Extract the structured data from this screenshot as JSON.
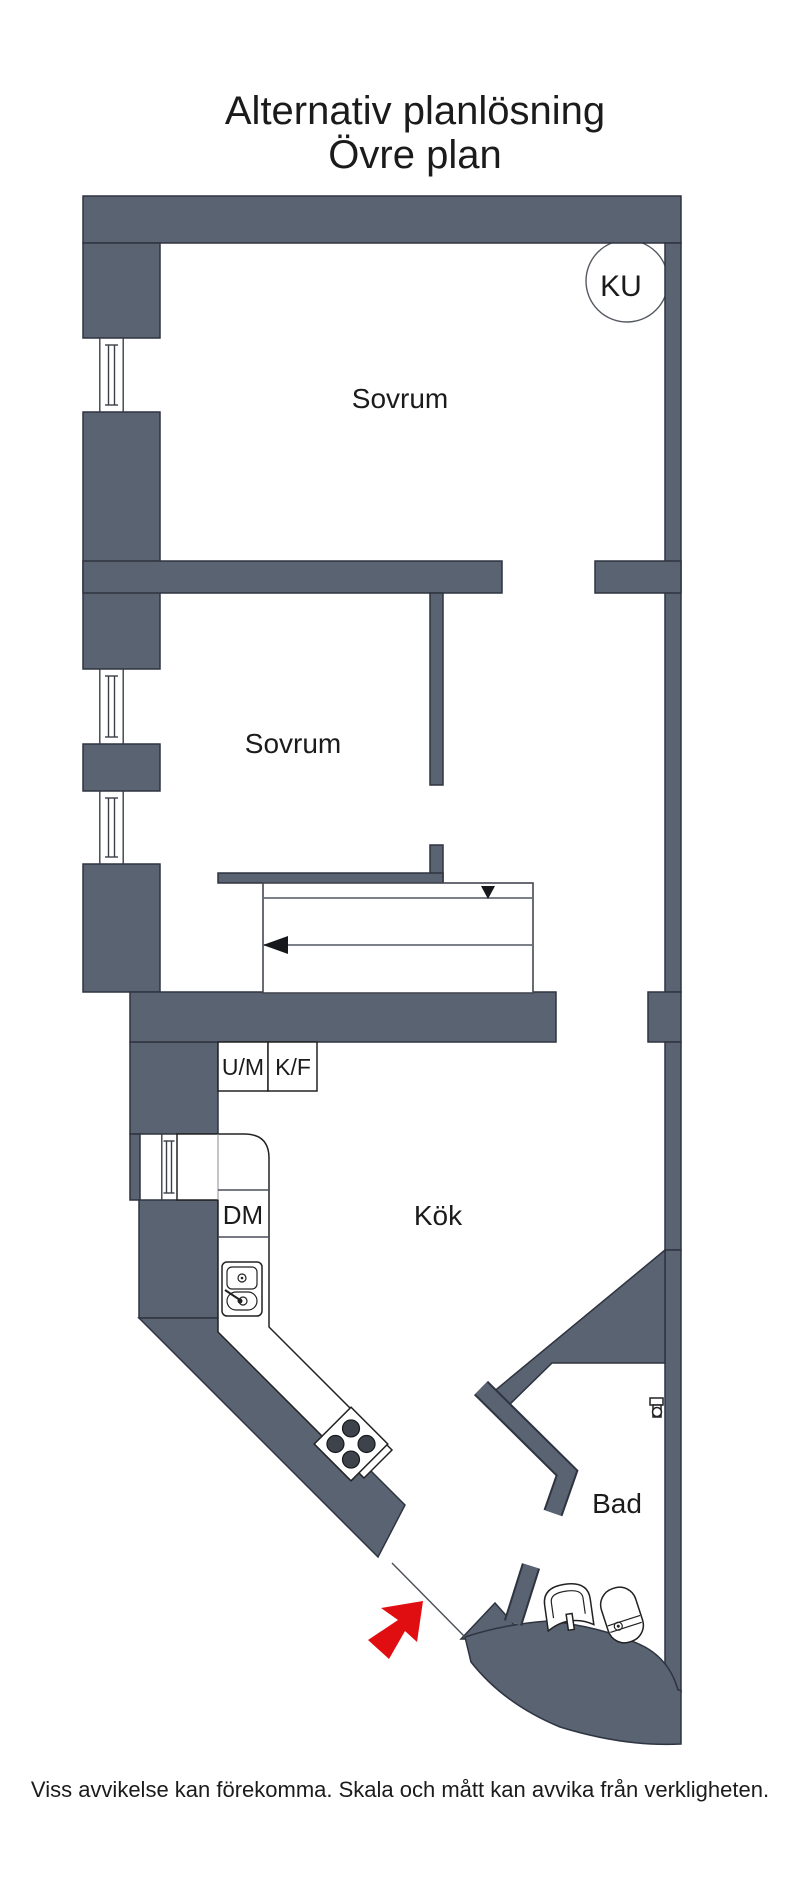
{
  "title": {
    "line1": "Alternativ planlösning",
    "line2": "Övre plan"
  },
  "rooms": {
    "bedroom_upper": "Sovrum",
    "bedroom_lower": "Sovrum",
    "kitchen": "Kök",
    "bathroom": "Bad"
  },
  "labels": {
    "ku": "KU",
    "um": "U/M",
    "kf": "K/F",
    "dm": "DM"
  },
  "footer": {
    "disclaimer": "Viss avvikelse kan förekomma. Skala och mått kan avvika från verkligheten."
  },
  "colors": {
    "wall": "#5a6372",
    "wall_outline": "#2e3440",
    "entrance_arrow": "#e10e11",
    "stair_line": "#6a6e78",
    "background": "#ffffff"
  },
  "icons": {
    "entrance_arrow": "red-ne-arrow",
    "stairs_down_arrow": "triangle-down",
    "stairs_direction_arrow": "arrow-left",
    "stove": "cooktop-4-burners",
    "kitchen_sink": "double-basin-sink",
    "toilet": "toilet-top-view",
    "washbasin": "washbasin-top-view",
    "paper_holder": "toilet-paper-holder",
    "window": "double-line-window"
  }
}
